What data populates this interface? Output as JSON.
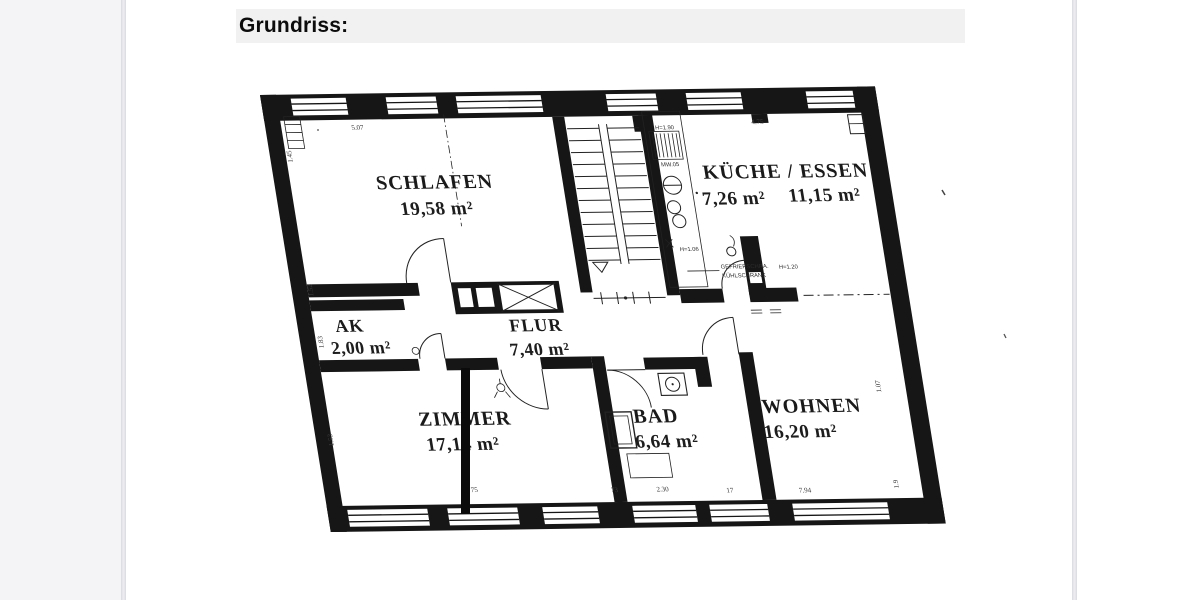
{
  "page": {
    "title": "Grundriss:"
  },
  "floorplan": {
    "rooms": {
      "schlafen": {
        "name": "SCHLAFEN",
        "area": "19,58 m²"
      },
      "kueche": {
        "name": "KÜCHE / ESSEN",
        "area_kueche": "7,26 m²",
        "area_essen": "11,15 m²"
      },
      "ak": {
        "name": "AK",
        "area": "2,00 m²"
      },
      "flur": {
        "name": "FLUR",
        "area": "7,40 m²"
      },
      "zimmer": {
        "name": "ZIMMER",
        "area": "17,14 m²"
      },
      "bad": {
        "name": "BAD",
        "area": "6,64 m²"
      },
      "wohnen": {
        "name": "WOHNEN",
        "area": "16,20 m²"
      }
    },
    "annotations": {
      "dim_top_left": "5.07",
      "dim_top_right": "4.75",
      "niche_height": "H=1.90",
      "niche_label": "MW.05",
      "counter_height": "H=1.06",
      "fridge_height": "H=1.20",
      "fridge_line1": "GEFRIERSCHRA.",
      "fridge_line2": "KÜHLSCHRANK",
      "dim_left_1": "1.45",
      "dim_left_2": "1.52",
      "dim_left_3": "1.83",
      "dim_left_4": "1.53",
      "dim_right_1": "1.07",
      "dim_right_2": "1.9",
      "dim_bottom_1": "75",
      "dim_bottom_2": "73",
      "dim_bottom_3": "2.30",
      "dim_bottom_4": "17",
      "dim_bottom_5": "7.94"
    }
  }
}
